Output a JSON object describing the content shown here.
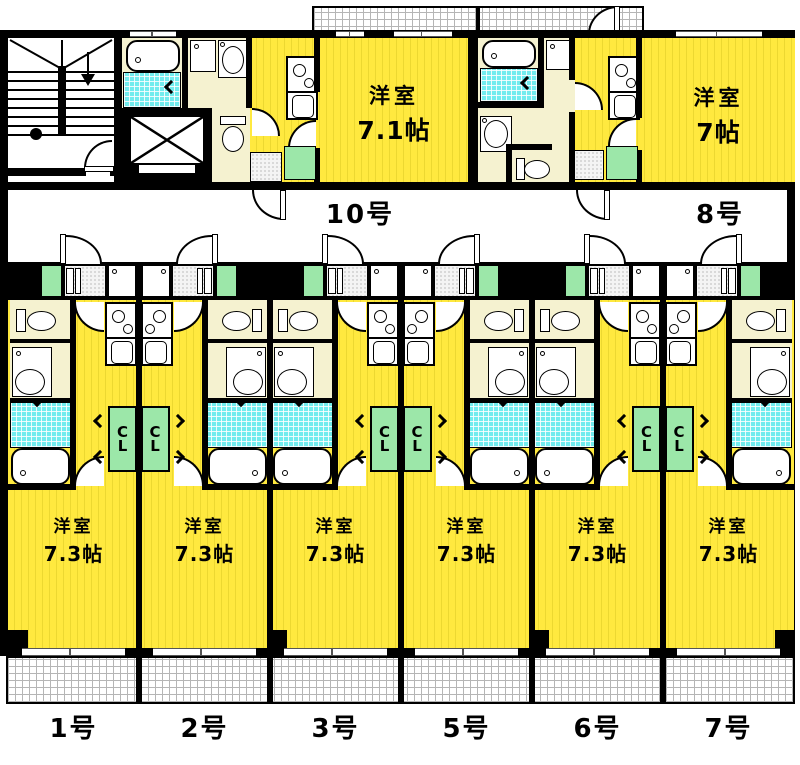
{
  "colors": {
    "wall": "#000000",
    "room_yellow": "#ffe93f",
    "room_yellow_line": "#ecd831",
    "cream": "#f5f2d0",
    "bath_cyan": "#72ecee",
    "closet_green": "#9ce7a9",
    "hatch_line": "#b5b5b5"
  },
  "labels": {
    "closet": "CL"
  },
  "top_units": [
    {
      "id": "10",
      "number": "10号",
      "room": "洋室",
      "size": "7.1帖"
    },
    {
      "id": "8",
      "number": "8号",
      "room": "洋室",
      "size": "7帖"
    }
  ],
  "bottom_units": [
    {
      "id": "1",
      "number": "1号",
      "room": "洋室",
      "size": "7.3帖",
      "mirror": false
    },
    {
      "id": "2",
      "number": "2号",
      "room": "洋室",
      "size": "7.3帖",
      "mirror": true
    },
    {
      "id": "3",
      "number": "3号",
      "room": "洋室",
      "size": "7.3帖",
      "mirror": false
    },
    {
      "id": "5",
      "number": "5号",
      "room": "洋室",
      "size": "7.3帖",
      "mirror": true
    },
    {
      "id": "6",
      "number": "6号",
      "room": "洋室",
      "size": "7.3帖",
      "mirror": false
    },
    {
      "id": "7",
      "number": "7号",
      "room": "洋室",
      "size": "7.3帖",
      "mirror": true
    }
  ]
}
